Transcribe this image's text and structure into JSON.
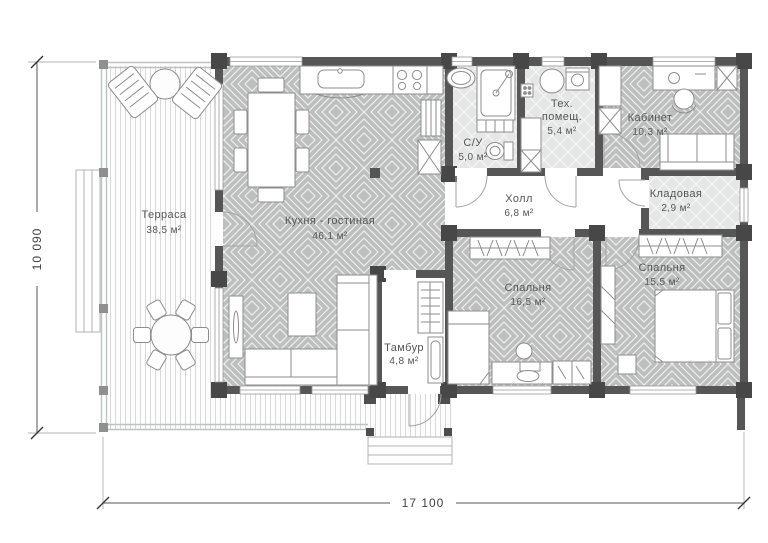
{
  "rooms": {
    "terrace": {
      "name": "Терраса",
      "area": "38,5 м²"
    },
    "kitchen_living": {
      "name": "Кухня - гостиная",
      "area": "46,1 м²"
    },
    "bathroom": {
      "name": "С/У",
      "area": "5,0 м²"
    },
    "utility": {
      "name_line1": "Тех.",
      "name_line2": "помещ.",
      "area": "5,4 м²"
    },
    "office": {
      "name": "Кабинет",
      "area": "10,3 м²"
    },
    "hall": {
      "name": "Холл",
      "area": "6,8 м²"
    },
    "storage": {
      "name": "Кладовая",
      "area": "2,9 м²"
    },
    "bedroom1": {
      "name": "Спальня",
      "area": "16,5 м²"
    },
    "bedroom2": {
      "name": "Спальня",
      "area": "15,5 м²"
    },
    "vestibule": {
      "name": "Тамбур",
      "area": "4,8 м²"
    }
  },
  "dimensions": {
    "vertical": "10 090",
    "horizontal": "17 100"
  },
  "colors": {
    "wall": "#565656",
    "floor_pattern": "#bdbfbe",
    "floor_light": "#e5e7e6",
    "railing": "#b9c4c0",
    "text": "#565656"
  }
}
